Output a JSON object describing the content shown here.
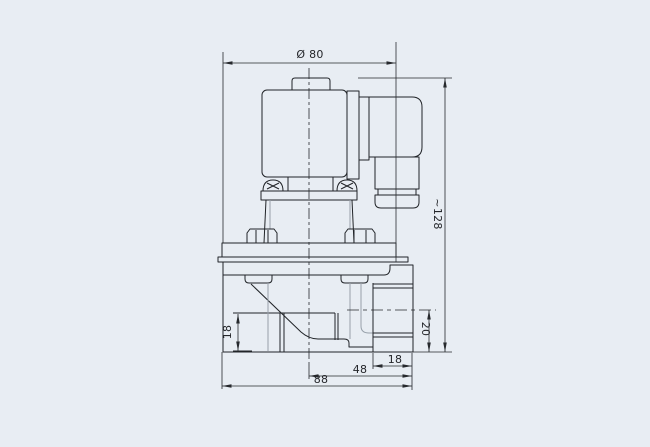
{
  "drawing": {
    "type": "engineering-dimension-drawing",
    "subject": "solenoid-pulse-valve-side-view",
    "colors": {
      "background": "#e8edf3",
      "line": "#212428"
    },
    "labels": {
      "coil_diameter": "Ø 80",
      "overall_height": "~128",
      "inlet_port_height": "18",
      "outlet_port_height": "20",
      "outlet_port_width": "18",
      "center_to_outlet_width": "48",
      "overall_width": "88"
    }
  }
}
